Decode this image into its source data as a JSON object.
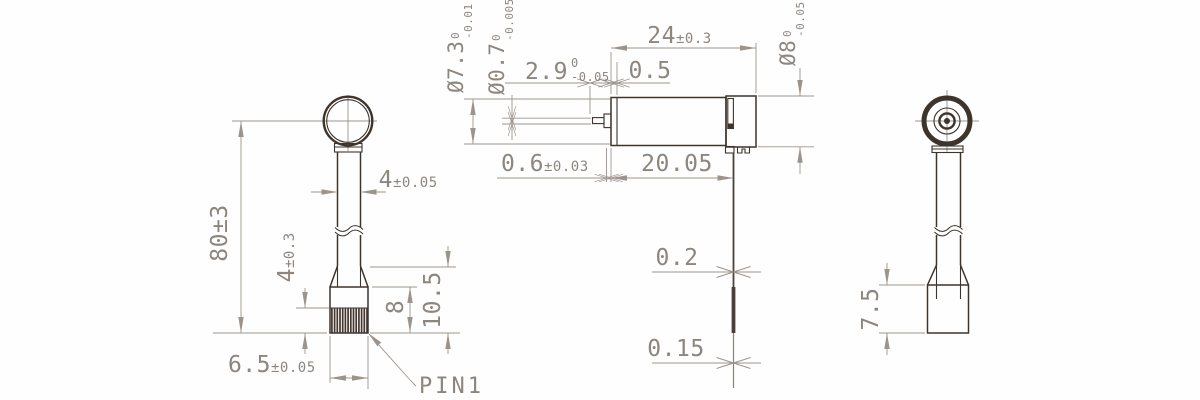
{
  "drawing": {
    "colors": {
      "object_line": "#3d342c",
      "dim_line": "#9c948b",
      "dim_text": "#8d867f"
    },
    "pin_label": "PIN1",
    "left_view": {
      "overall_length": "80±3",
      "stem_width": {
        "value": "4",
        "tolerance": "±0.05"
      },
      "rib_section_height": {
        "value": "4",
        "tolerance": "±0.3"
      },
      "block_height": "8",
      "base_height": "10.5",
      "base_width": {
        "value": "6.5",
        "tolerance": "±0.05"
      }
    },
    "center_view": {
      "body_diameter": {
        "value": "Ø7.3",
        "tol_upper": "0",
        "tol_lower": "-0.01"
      },
      "shaft_diameter": {
        "value": "Ø0.7",
        "tol_upper": "0",
        "tol_lower": "-0.005"
      },
      "ring_diameter": {
        "value": "Ø8",
        "tol_upper": "0",
        "tol_lower": "-0.05"
      },
      "shaft_length": {
        "value": "2.9",
        "tol_upper": "0",
        "tol_lower": "-0.05"
      },
      "end_cap_width": "0.5",
      "total_length": {
        "value": "24",
        "tolerance": "±0.3"
      },
      "left_cap_thickness": {
        "value": "0.6",
        "tolerance": "±0.03"
      },
      "body_length": "20.05",
      "lead_wire_dia_upper": "0.2",
      "lead_wire_dia_lower": "0.15"
    },
    "right_view": {
      "base_height": "7.5"
    }
  }
}
